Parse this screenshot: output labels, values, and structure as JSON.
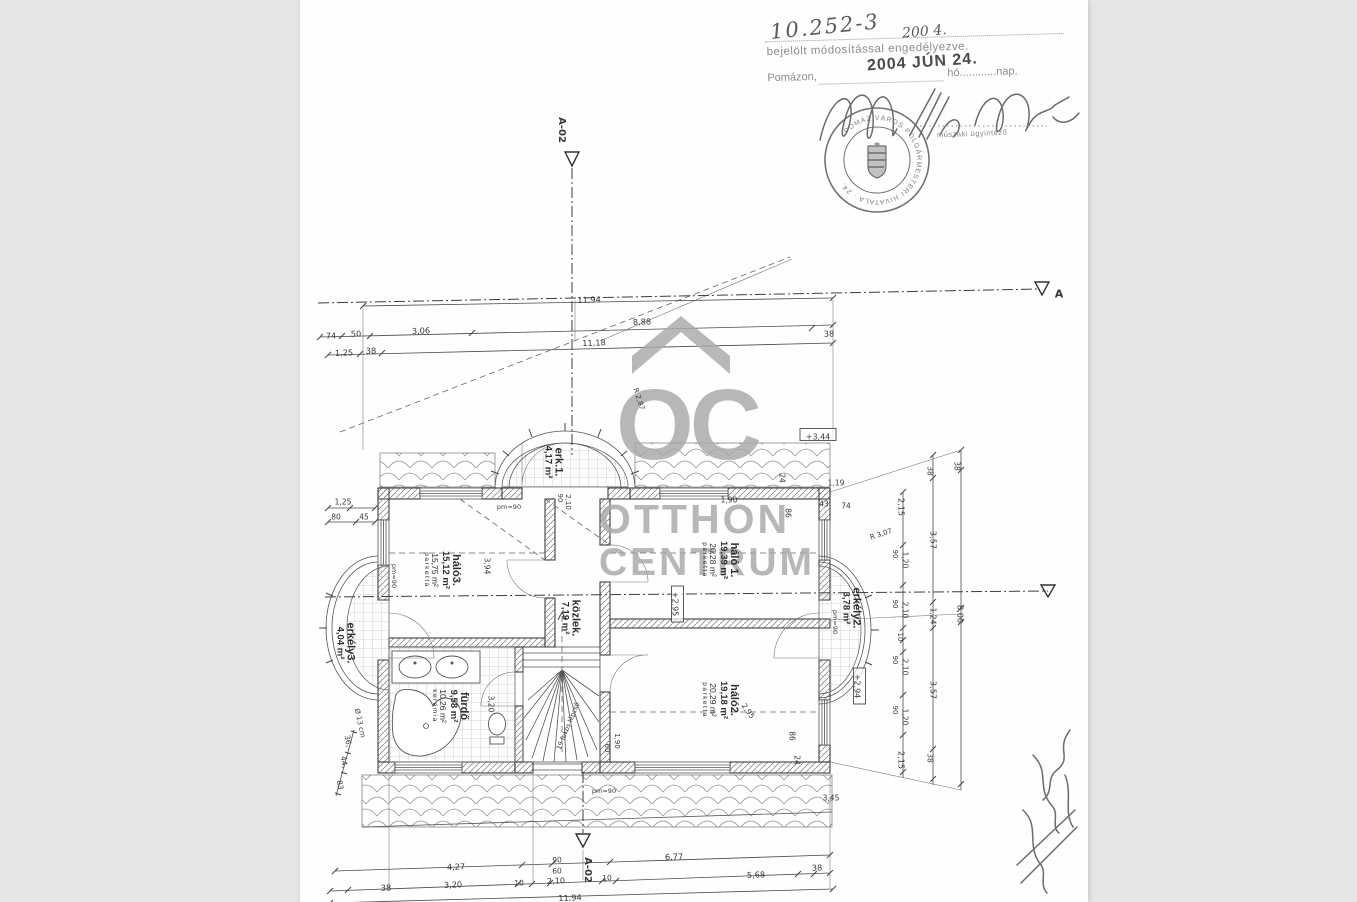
{
  "colors": {
    "background": "#e5e5e5",
    "paper": "#fefefe",
    "ink": "#3f3f3f",
    "watermark_gray": "#a8a8a8",
    "stamp_gray": "#5a5a5a"
  },
  "approval": {
    "case_number": "10.252-3",
    "case_number2": "200 4.",
    "approval_text": "bejelölt módosítással engedélyezve.",
    "place_label": "Pomázon,",
    "date_stamp": "2004 JÚN 24.",
    "month_day_labels": "hó............nap.",
    "signature_role": "műszaki ügyintéző",
    "seal_text": "POMÁZ VÁROS POLGÁRMESTERI HIVATALA",
    "seal_number": "24."
  },
  "watermark": {
    "logo": "OC",
    "line1": "OTTHON",
    "line2": "CENTRUM"
  },
  "section_markers": {
    "top": "A-02",
    "bottom": "A-02",
    "right": "A"
  },
  "rooms": [
    {
      "id": "halo3",
      "name": "háló3.",
      "area": "15,12 m²",
      "area2": "15,75 m²",
      "floor": "parketta",
      "x": 142,
      "y": 570
    },
    {
      "id": "furdo",
      "name": "fürdő",
      "area": "9,58 m²",
      "area2": "10,26 m²",
      "floor": "kerámia",
      "x": 150,
      "y": 706
    },
    {
      "id": "kozlek",
      "name": "közlek.",
      "area": "7,19 m²",
      "area2": "",
      "floor": "",
      "x": 270,
      "y": 618
    },
    {
      "id": "halo1",
      "name": "háló 1.",
      "area": "19,39 m²",
      "area2": "20,28 m²",
      "floor": "parketta",
      "x": 420,
      "y": 560
    },
    {
      "id": "halo2",
      "name": "háló2.",
      "area": "19,18 m²",
      "area2": "20,29 m²",
      "floor": "parketta",
      "x": 420,
      "y": 700
    },
    {
      "id": "erk1",
      "name": "erk.1.",
      "area": "4,17 m²",
      "area2": "",
      "floor": "",
      "x": 253,
      "y": 462
    },
    {
      "id": "erkely2",
      "name": "erkély2.",
      "area": "3,78 m²",
      "area2": "",
      "floor": "",
      "x": 551,
      "y": 608
    },
    {
      "id": "erkely3",
      "name": "erkély3.",
      "area": "4,04 m²",
      "area2": "",
      "floor": "",
      "x": 45,
      "y": 643
    }
  ],
  "plan": {
    "labels": [
      {
        "t": "11,94",
        "x": 289,
        "y": 300,
        "r": -2
      },
      {
        "t": "74",
        "x": 31,
        "y": 336,
        "r": -2
      },
      {
        "t": "50",
        "x": 56,
        "y": 334,
        "r": -2
      },
      {
        "t": "3,06",
        "x": 121,
        "y": 331,
        "r": -2
      },
      {
        "t": "8,88",
        "x": 342,
        "y": 322,
        "r": -2
      },
      {
        "t": "38",
        "x": 529,
        "y": 334,
        "r": -2
      },
      {
        "t": "1,25",
        "x": 44,
        "y": 353,
        "r": -2
      },
      {
        "t": "38",
        "x": 71,
        "y": 351,
        "r": -2
      },
      {
        "t": "11,18",
        "x": 294,
        "y": 343,
        "r": -2
      },
      {
        "t": "4,27",
        "x": 156,
        "y": 867,
        "r": -2
      },
      {
        "t": "90",
        "x": 257,
        "y": 860,
        "r": -2,
        "s": 7.5
      },
      {
        "t": "60",
        "x": 257,
        "y": 871,
        "r": -2,
        "s": 7.5
      },
      {
        "t": "6,77",
        "x": 374,
        "y": 857,
        "r": -2
      },
      {
        "t": "38",
        "x": 517,
        "y": 868,
        "r": -2
      },
      {
        "t": "38",
        "x": 86,
        "y": 888,
        "r": -2
      },
      {
        "t": "3,20",
        "x": 153,
        "y": 885,
        "r": -2
      },
      {
        "t": "10",
        "x": 219,
        "y": 883,
        "r": -2,
        "s": 7.5
      },
      {
        "t": "2,10",
        "x": 256,
        "y": 881,
        "r": -2
      },
      {
        "t": "10",
        "x": 307,
        "y": 878,
        "r": -2,
        "s": 7.5
      },
      {
        "t": "5,68",
        "x": 456,
        "y": 875,
        "r": -2
      },
      {
        "t": "11,94",
        "x": 270,
        "y": 898,
        "r": -2
      },
      {
        "t": "2,15",
        "x": 601,
        "y": 507,
        "r": 90
      },
      {
        "t": "90",
        "x": 595,
        "y": 554,
        "r": 90,
        "s": 7
      },
      {
        "t": "1,20",
        "x": 605,
        "y": 560,
        "r": 90,
        "s": 7.5
      },
      {
        "t": "90",
        "x": 595,
        "y": 604,
        "r": 90,
        "s": 7
      },
      {
        "t": "2,10",
        "x": 605,
        "y": 610,
        "r": 90,
        "s": 7.5
      },
      {
        "t": "10",
        "x": 600,
        "y": 637,
        "r": 90,
        "s": 7
      },
      {
        "t": "90",
        "x": 595,
        "y": 660,
        "r": 90,
        "s": 7
      },
      {
        "t": "2,10",
        "x": 605,
        "y": 667,
        "r": 90,
        "s": 7.5
      },
      {
        "t": "90",
        "x": 595,
        "y": 710,
        "r": 90,
        "s": 7
      },
      {
        "t": "1,20",
        "x": 605,
        "y": 717,
        "r": 90,
        "s": 7.5
      },
      {
        "t": "2,15",
        "x": 601,
        "y": 760,
        "r": 90
      },
      {
        "t": "38",
        "x": 630,
        "y": 471,
        "r": 90,
        "s": 7.5
      },
      {
        "t": "3,57",
        "x": 633,
        "y": 540,
        "r": 90
      },
      {
        "t": "1,24",
        "x": 633,
        "y": 616,
        "r": 90,
        "s": 7.5
      },
      {
        "t": "3,57",
        "x": 633,
        "y": 690,
        "r": 90
      },
      {
        "t": "38",
        "x": 630,
        "y": 758,
        "r": 90,
        "s": 7.5
      },
      {
        "t": "38",
        "x": 657,
        "y": 466,
        "r": 90,
        "s": 7.5
      },
      {
        "t": "8,00",
        "x": 660,
        "y": 614,
        "r": 90
      },
      {
        "t": "1,25",
        "x": 43,
        "y": 502,
        "s": 7.5
      },
      {
        "t": "80",
        "x": 36,
        "y": 517,
        "s": 7.5
      },
      {
        "t": "45",
        "x": 64,
        "y": 517,
        "s": 7.5
      },
      {
        "t": "Ø 13 cm",
        "x": 60,
        "y": 723,
        "r": 78,
        "s": 7
      },
      {
        "t": "36,",
        "x": 48,
        "y": 741,
        "r": 80,
        "s": 7.5
      },
      {
        "t": "44,",
        "x": 44,
        "y": 762,
        "r": 80,
        "s": 7.5
      },
      {
        "t": "83",
        "x": 40,
        "y": 785,
        "r": 80,
        "s": 7.5
      },
      {
        "t": "1,19",
        "x": 536,
        "y": 483,
        "s": 7.5
      },
      {
        "t": "43",
        "x": 524,
        "y": 504,
        "s": 7.5
      },
      {
        "t": "74",
        "x": 546,
        "y": 506,
        "s": 7.5
      },
      {
        "t": "86",
        "x": 488,
        "y": 513,
        "r": 90,
        "s": 7.5
      },
      {
        "t": "86",
        "x": 492,
        "y": 736,
        "r": 90,
        "s": 7.5
      },
      {
        "t": "24",
        "x": 482,
        "y": 478,
        "r": 90,
        "s": 7.5
      },
      {
        "t": "24",
        "x": 497,
        "y": 760,
        "r": 90,
        "s": 7.5
      },
      {
        "t": "1,90",
        "x": 429,
        "y": 500,
        "s": 7.5
      },
      {
        "t": "R 3,07",
        "x": 581,
        "y": 534,
        "r": -18,
        "s": 7
      },
      {
        "t": "R 2,87",
        "x": 339,
        "y": 399,
        "r": 72,
        "s": 7
      },
      {
        "t": "pm=90",
        "x": 209,
        "y": 507,
        "s": 6.5
      },
      {
        "t": "pm=90",
        "x": 94,
        "y": 576,
        "r": 90,
        "s": 6.5
      },
      {
        "t": "pm=90",
        "x": 304,
        "y": 791,
        "s": 6.5
      },
      {
        "t": "pm=90",
        "x": 535,
        "y": 622,
        "r": 90,
        "s": 6.5
      },
      {
        "t": "2,10",
        "x": 268,
        "y": 502,
        "r": 90,
        "s": 7
      },
      {
        "t": "90",
        "x": 260,
        "y": 498,
        "r": 90,
        "s": 7
      },
      {
        "t": "3,94",
        "x": 187,
        "y": 566,
        "r": 90,
        "s": 7.5
      },
      {
        "t": "3,20",
        "x": 191,
        "y": 704,
        "r": 90,
        "s": 7.5
      },
      {
        "t": "2,95",
        "x": 448,
        "y": 711,
        "r": 55,
        "s": 7.5
      },
      {
        "t": "60",
        "x": 307,
        "y": 748,
        "r": 90,
        "s": 7
      },
      {
        "t": "1,90",
        "x": 317,
        "y": 741,
        "r": 90,
        "s": 7
      },
      {
        "t": "3,45",
        "x": 531,
        "y": 798,
        "s": 7.5
      },
      {
        "t": "19 fokos lépcső",
        "x": 268,
        "y": 726,
        "r": -68,
        "s": 6.5
      },
      {
        "t": "+3,44",
        "x": 518,
        "y": 437,
        "box": 1,
        "s": 8
      },
      {
        "t": "+2,95",
        "x": 375,
        "y": 604,
        "r": 90,
        "box": 1,
        "s": 8
      },
      {
        "t": "+2,94",
        "x": 557,
        "y": 686,
        "r": 90,
        "box": 1,
        "s": 8
      },
      {
        "t": "A-02",
        "x": 262,
        "y": 130,
        "r": 90,
        "s": 10,
        "b": 1,
        "n": "section-marker-a02-top"
      },
      {
        "t": "A-02",
        "x": 288,
        "y": 870,
        "r": 90,
        "s": 10,
        "b": 1,
        "n": "section-marker-a02-bottom"
      },
      {
        "t": "A",
        "x": 759,
        "y": 294,
        "s": 11,
        "b": 1,
        "n": "section-marker-a-right"
      }
    ]
  }
}
